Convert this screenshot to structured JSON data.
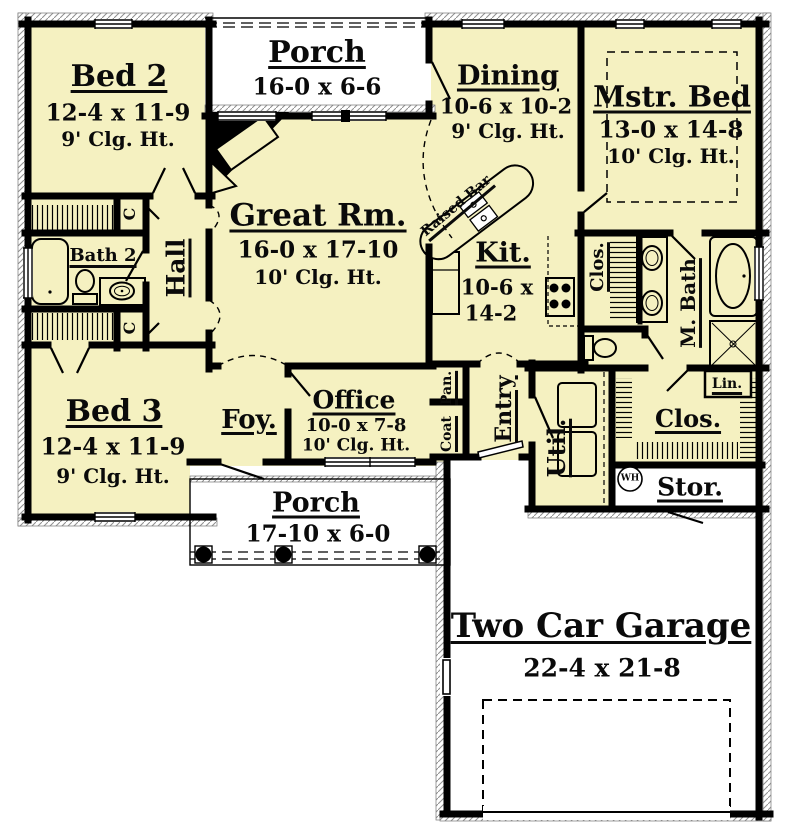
{
  "rooms": {
    "bed2": {
      "name": "Bed 2",
      "dim": "12-4 x 11-9",
      "clg": "9' Clg. Ht."
    },
    "porch_top": {
      "name": "Porch",
      "dim": "16-0 x 6-6"
    },
    "dining": {
      "name": "Dining",
      "dim": "10-6 x 10-2",
      "clg": "9' Clg. Ht."
    },
    "mstr_bed": {
      "name": "Mstr. Bed",
      "dim": "13-0 x 14-8",
      "clg": "10' Clg. Ht."
    },
    "great_rm": {
      "name": "Great Rm.",
      "dim": "16-0 x 17-10",
      "clg": "10' Clg. Ht."
    },
    "bath2": {
      "name": "Bath 2"
    },
    "hall": {
      "name": "Hall"
    },
    "raised_bar": {
      "name": "Raised Bar"
    },
    "kit": {
      "name": "Kit.",
      "dim_line1": "10-6 x",
      "dim_line2": "14-2"
    },
    "clos_master": {
      "name": "Clos."
    },
    "m_bath": {
      "name": "M. Bath"
    },
    "bed3": {
      "name": "Bed 3",
      "dim": "12-4 x 11-9",
      "clg": "9' Clg. Ht."
    },
    "foy": {
      "name": "Foy."
    },
    "office": {
      "name": "Office",
      "dim": "10-0 x 7-8",
      "clg": "10' Clg. Ht."
    },
    "pan": {
      "name": "Pan."
    },
    "coat": {
      "name": "Coat"
    },
    "entry": {
      "name": "Entry"
    },
    "util": {
      "name": "Util."
    },
    "clos_right": {
      "name": "Clos."
    },
    "lin": {
      "name": "Lin."
    },
    "stor": {
      "name": "Stor."
    },
    "porch_bottom": {
      "name": "Porch",
      "dim": "17-10 x 6-0"
    },
    "garage": {
      "name": "Two Car Garage",
      "dim": "22-4 x 21-8"
    }
  },
  "markers": {
    "closet_c_top": "C",
    "closet_c_bottom": "C",
    "water_heater": "WH"
  },
  "colors": {
    "room_fill": "#F5F1C1",
    "wall": "#000000",
    "outside": "#FFFFFF",
    "hatch": "#8f8f8f"
  }
}
